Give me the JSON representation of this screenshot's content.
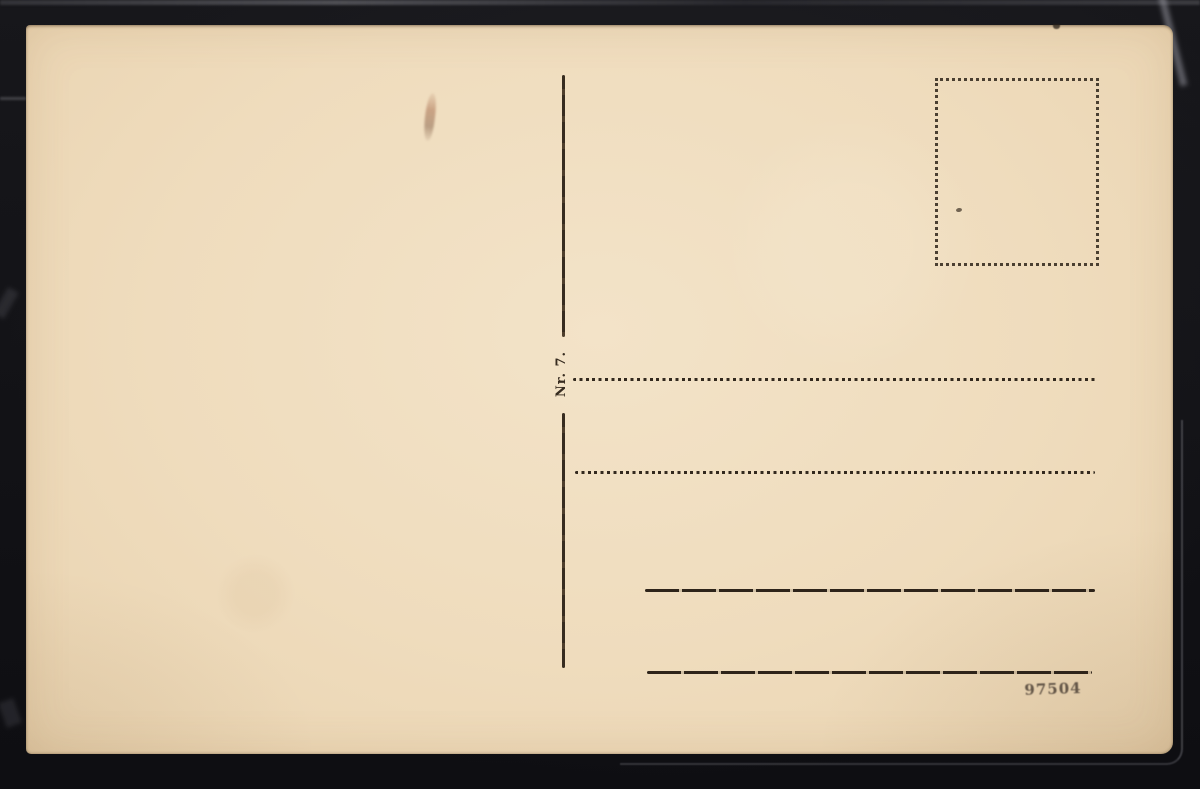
{
  "colors": {
    "backdrop": "#131317",
    "card_paper": "#efdcbd",
    "ink": "#33291e",
    "serial_ink": "#4e4237",
    "stain": "#a4694a"
  },
  "postcard": {
    "divider_label": "Nr. 7.",
    "serial_number": "97504",
    "stamp_box_style": "dotted",
    "address_lines": {
      "dotted_count": 2,
      "solid_count": 2
    }
  }
}
